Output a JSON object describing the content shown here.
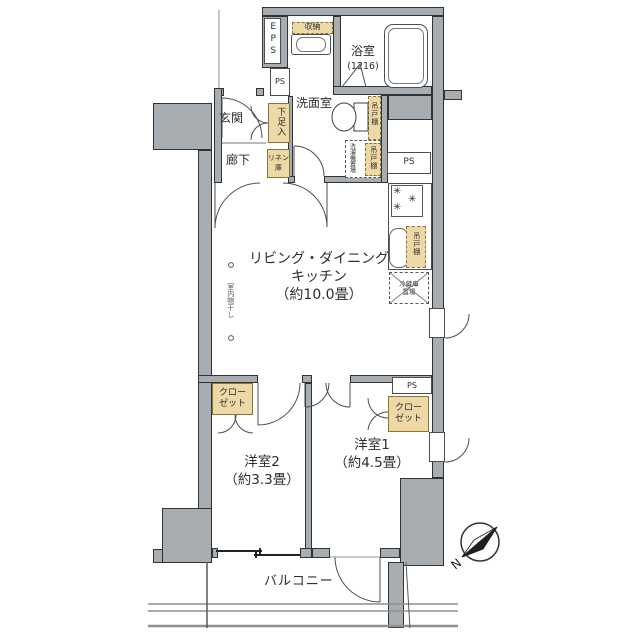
{
  "palette": {
    "wall_fill": "#a8adb1",
    "wall_edge": "#2f3335",
    "storage_fill": "#edd8a6",
    "storage_edge": "#8a7437",
    "line": "#3c4043",
    "text": "#2b2e30"
  },
  "rooms": {
    "ldk": {
      "line1": "リビング・ダイニング",
      "line2": "キッチン",
      "line3": "（約10.0畳）"
    },
    "bedroom1": {
      "name": "洋室1",
      "size": "（約4.5畳）"
    },
    "bedroom2": {
      "name": "洋室2",
      "size": "（約3.3畳）"
    },
    "bath": {
      "name": "浴室",
      "size": "(1216)"
    },
    "washroom": {
      "name": "洗面室"
    },
    "entrance": {
      "name": "玄関"
    },
    "hallway": {
      "name": "廊下"
    },
    "balcony": {
      "name": "バルコニー"
    }
  },
  "storage": {
    "shoe_cabinet": "下足入",
    "linen": {
      "line1": "リネン",
      "line2": "庫"
    },
    "hall_storage": "収納",
    "hanging_cupboard": "吊戸棚",
    "closet": {
      "line1": "クロー",
      "line2": "ゼット"
    }
  },
  "equipment": {
    "washer_space": "洗濯機置場",
    "fridge_space": {
      "line1": "冷蔵庫",
      "line2": "置場"
    },
    "indoor_drying": "室内物干し"
  },
  "shafts": {
    "eps": "EPS",
    "ps": "PS"
  },
  "compass": {
    "north": "N"
  },
  "icons": {
    "burner": "✳"
  }
}
